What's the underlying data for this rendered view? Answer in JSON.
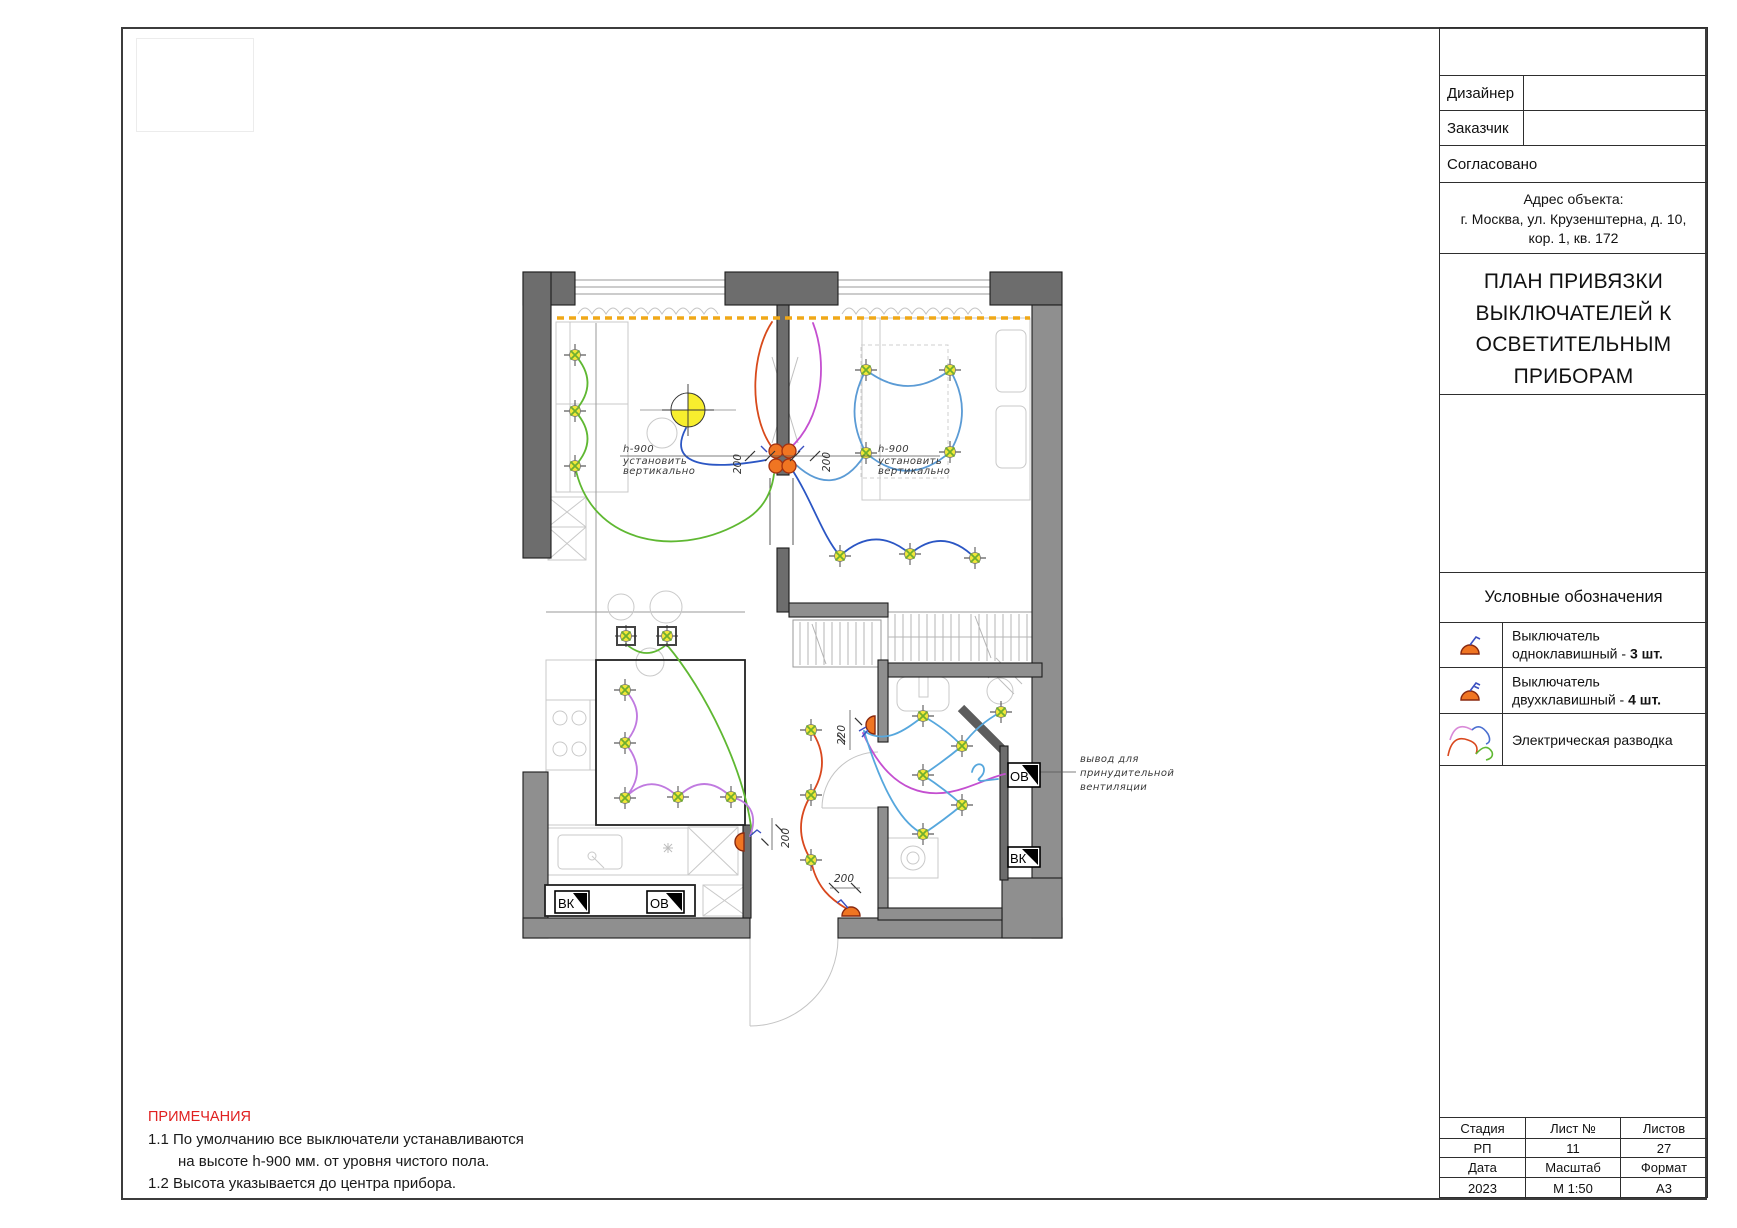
{
  "title_block": {
    "designer_label": "Дизайнер",
    "client_label": "Заказчик",
    "approved_label": "Согласовано",
    "address_heading": "Адрес объекта:",
    "address_line1": "г. Москва, ул. Крузенштерна, д. 10,",
    "address_line2": "кор. 1, кв. 172",
    "title_lines": [
      "ПЛАН ПРИВЯЗКИ",
      "ВЫКЛЮЧАТЕЛЕЙ К",
      "ОСВЕТИТЕЛЬНЫМ",
      "ПРИБОРАМ"
    ],
    "legend": {
      "heading": "Условные обозначения",
      "item1_line1": "Выключатель",
      "item1_line2": "одноклавишный - ",
      "item1_count": "3 шт.",
      "item1_icon": "single-switch-icon",
      "item2_line1": "Выключатель",
      "item2_line2": "двухклавишный - ",
      "item2_count": "4 шт.",
      "item2_icon": "double-switch-icon",
      "item3_label": "Электрическая разводка",
      "item3_icon": "wiring-icon"
    },
    "footer": {
      "stage_label": "Стадия",
      "sheet_no_label": "Лист №",
      "sheets_label": "Листов",
      "stage_value": "РП",
      "sheet_no_value": "11",
      "sheets_value": "27",
      "date_label": "Дата",
      "scale_label": "Масштаб",
      "format_label": "Формат",
      "date_value": "2023",
      "scale_value": "М 1:50",
      "format_value": "А3"
    }
  },
  "notes": {
    "heading": "ПРИМЕЧАНИЯ",
    "line1": "1.1 По умолчанию все выключатели устанавливаются",
    "line2": "на высоте h-900 мм. от уровня чистого пола.",
    "line3": "1.2 Высота указывается до центра прибора."
  },
  "plan": {
    "switch_note": [
      "h-900",
      "установить",
      "вертикально"
    ],
    "vent_note": [
      "вывод для",
      "принудительной",
      "вентиляции"
    ],
    "dim_200": "200",
    "dim_220": "220",
    "vk": "ВК",
    "ov": "ОВ",
    "colors": {
      "wire_green": "#5fb832",
      "wire_blue": "#2b56c4",
      "wire_light_blue": "#5b9bd5",
      "wire_violet": "#c07ae0",
      "wire_magenta": "#c44fd0",
      "wire_red": "#d84a1b",
      "wire_orange": "#d9481e",
      "wire_bath_blue": "#56a7dd",
      "switch_fill": "#f07522",
      "highlight_yellow": "#f0a818",
      "pendant_yellow": "#f7ee2e",
      "note_red": "#e02020",
      "wall_dark": "#6d6d6d",
      "wall_mid": "#8f8f8f"
    }
  }
}
